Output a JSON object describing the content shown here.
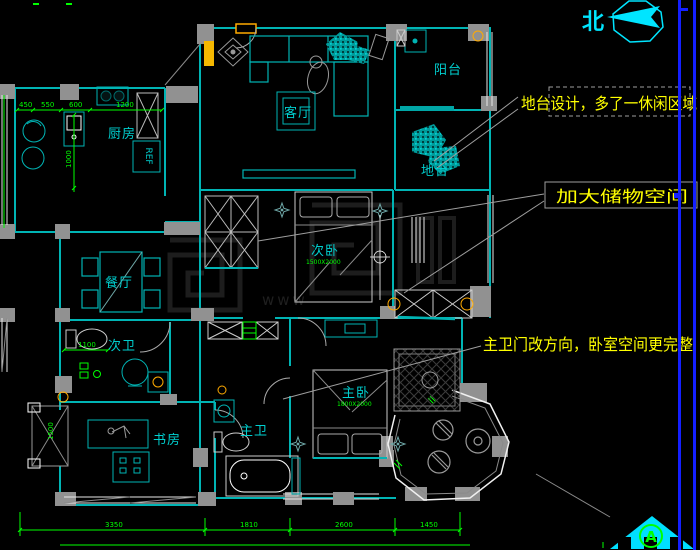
{
  "north": {
    "label": "北"
  },
  "section_marker": {
    "label": "A"
  },
  "rooms": {
    "kitchen": "厨房",
    "living": "客厅",
    "balcony": "阳台",
    "platform": "地台",
    "bedroom2": "次卧",
    "dining": "餐厅",
    "bath2": "次卫",
    "study": "书房",
    "bath_master": "主卫",
    "bedroom_master": "主卧"
  },
  "beds": {
    "bedroom2_size": "1500X2000",
    "master_size": "1800X2000"
  },
  "appliance": {
    "fridge": "REF"
  },
  "annotations": {
    "platform": "地台设计，多了一休闲区域",
    "storage": "加大储物空间",
    "master_bath": "主卫门改方向，卧室空间更完整"
  },
  "dimensions": {
    "kitchen_top": [
      "450",
      "550",
      "600",
      "1200"
    ],
    "kitchen_depth": "1000",
    "bath2_width": "1100",
    "study_bay": "1500",
    "bottom": [
      "3350",
      "1810",
      "2600",
      "1450"
    ]
  },
  "watermark": {
    "text": "www"
  },
  "colors": {
    "wall": "#00b4b4",
    "bright_cyan": "#00e5ff",
    "dimension_green": "#00ff00",
    "annotation_yellow": "#ffff00",
    "leader_gray": "#9e9e9e",
    "column_gray": "#919191",
    "scroll_blue": "#1420ff",
    "fixture_orange": "#ffaa00"
  }
}
